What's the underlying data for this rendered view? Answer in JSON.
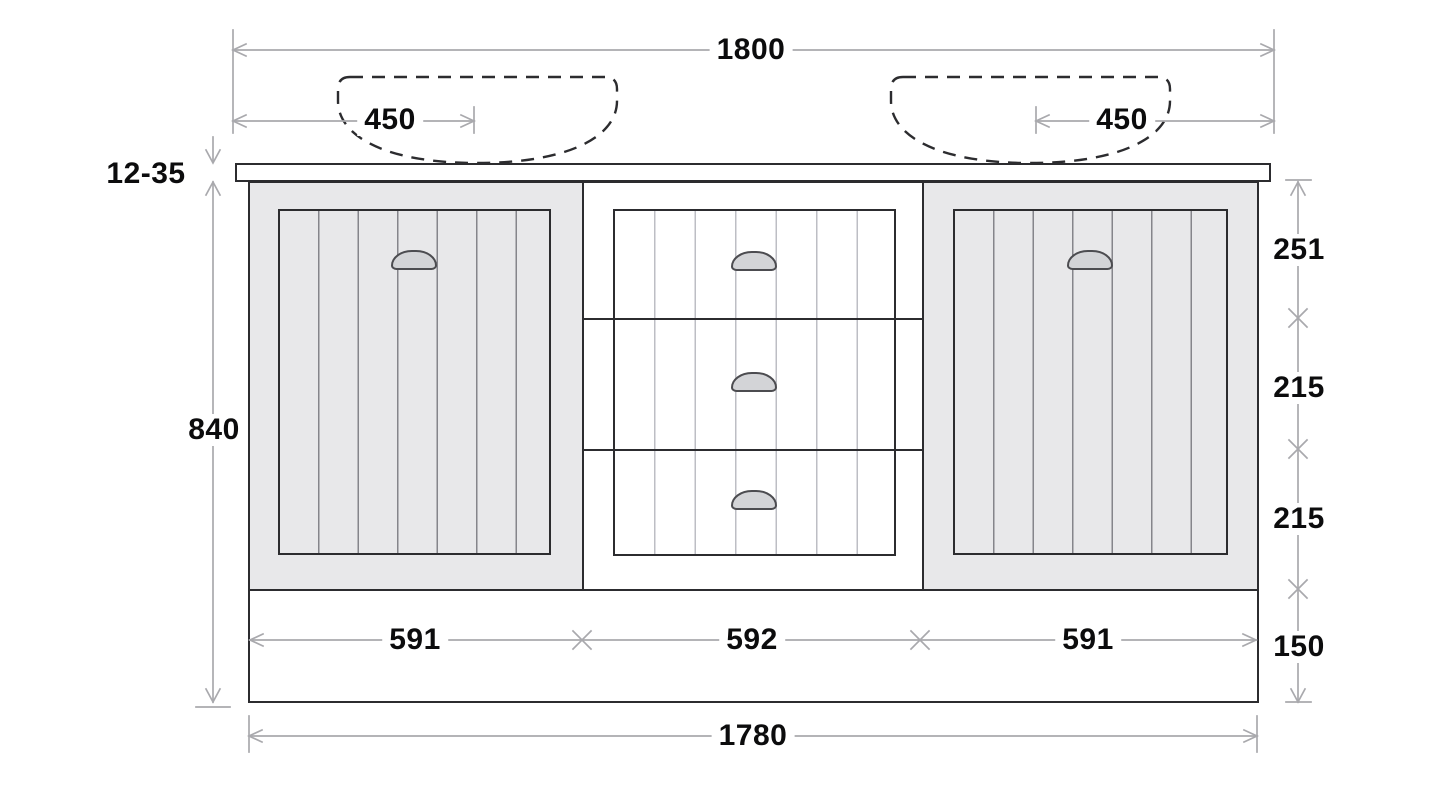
{
  "drawing": {
    "subject": "double-sink-vanity-elevation",
    "dimensions": {
      "overall_width": "1800",
      "left_sink_offset": "450",
      "right_sink_offset": "450",
      "countertop_thickness": "12-35",
      "cabinet_height": "840",
      "top_drawer_height": "251",
      "middle_drawer_height": "215",
      "lower_drawer_height": "215",
      "plinth_height": "150",
      "left_section_width": "591",
      "center_section_width": "592",
      "right_section_width": "591",
      "carcass_width": "1780"
    },
    "colors": {
      "outline": "#2c2c2f",
      "cabinet_fill": "#e8e8ea",
      "handle_fill": "#d3d4d7",
      "dimension_line": "#a9a9ad",
      "text": "#0c0c0d"
    }
  }
}
